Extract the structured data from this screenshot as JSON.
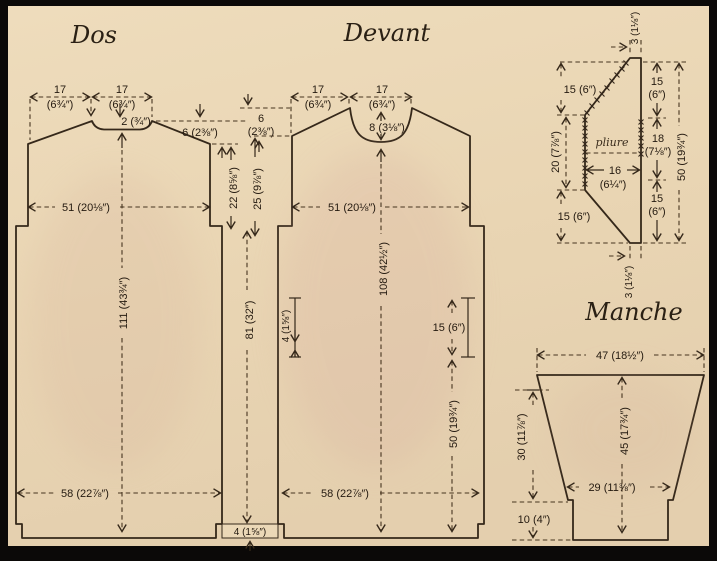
{
  "palette": {
    "frame": "#0b0908",
    "paper": "#ebd8b7",
    "piece_fill": "#d9bda1",
    "line": "#35281a",
    "text": "#241a10"
  },
  "dos": {
    "title": "Dos",
    "shoulder_num": "17",
    "shoulder_in": "(6¾″)",
    "neck_num": "17",
    "neck_in": "(6¾″)",
    "neck_depth": "2 (¾″)",
    "shoulder_drop": "6 (2⅜″)",
    "chest": "51 (20⅛″)",
    "length": "111 (43¾″)",
    "hem": "58 (22⅞″)"
  },
  "center": {
    "front_drop_num": "6",
    "front_drop_in": "(2⅜″)",
    "back_armhole": "22 (8⅝″)",
    "front_armhole": "25 (9⅞″)",
    "side_seam": "81 (32″)",
    "hem_band": "4 (1⅝″)"
  },
  "devant": {
    "title": "Devant",
    "shoulder_num": "17",
    "shoulder_in": "(6¾″)",
    "neck_num": "17",
    "neck_in": "(6¾″)",
    "neck_depth": "8 (3⅛″)",
    "chest": "51 (20⅛″)",
    "length": "108 (42½″)",
    "side_slit": "4 (1⅝″)",
    "side_detail": "15 (6″)",
    "side_lower": "50 (19¾″)",
    "hem": "58 (22⅞″)"
  },
  "collar": {
    "fold": "pliure",
    "top_width": "3 (1⅛″)",
    "left_upper": "15 (6″)",
    "left_middle": "20 (7⅞″)",
    "left_lower": "15 (6″)",
    "width_num": "16",
    "width_in": "(6¼″)",
    "right_upper_num": "15",
    "right_upper_in": "(6″)",
    "right_middle_num": "18",
    "right_middle_in": "(7⅛″)",
    "right_lower_num": "15",
    "right_lower_in": "(6″)",
    "total_height": "50 (19¾″)",
    "bottom_width": "3 (1⅛″)"
  },
  "manche": {
    "title": "Manche",
    "top_width": "47 (18½″)",
    "underarm": "30 (11⅞″)",
    "length": "45 (17¾″)",
    "wrist": "29 (11⅜″)",
    "cuff": "10 (4″)"
  }
}
